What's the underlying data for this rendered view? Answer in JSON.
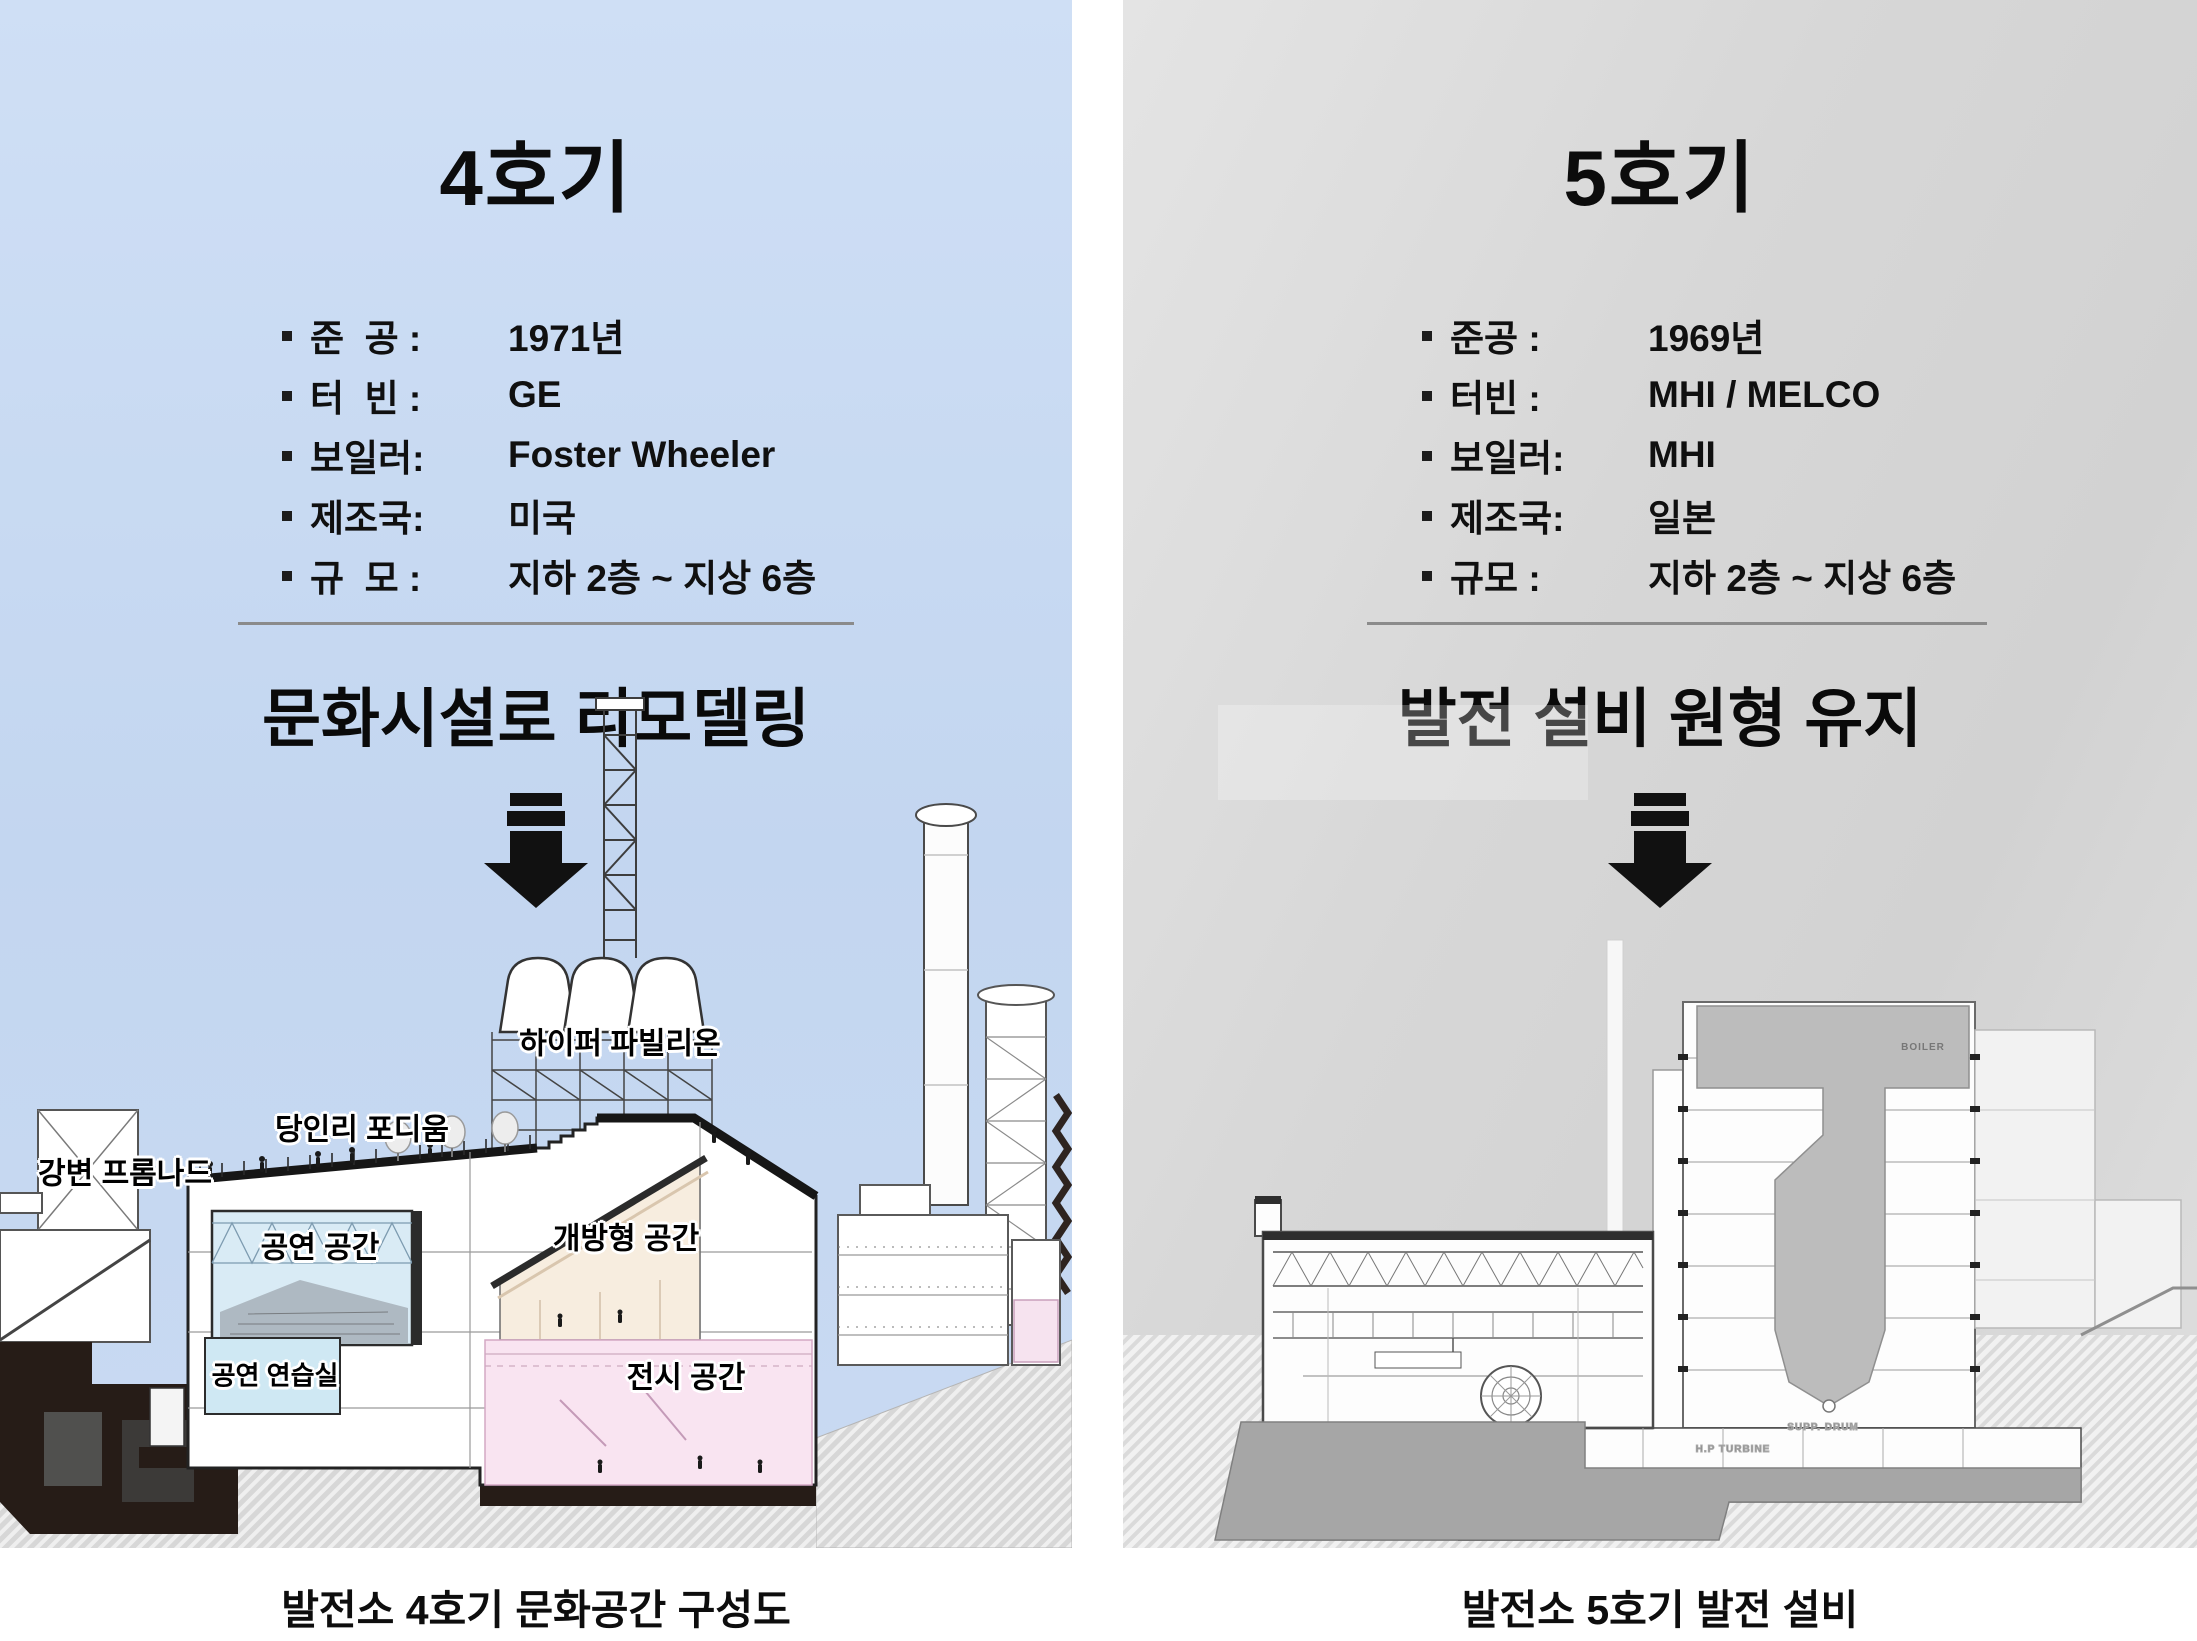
{
  "left": {
    "title": "4호기",
    "specs": [
      {
        "label": "준  공 :",
        "value": "1971년"
      },
      {
        "label": "터  빈 :",
        "value": "GE"
      },
      {
        "label": "보일러:",
        "value": "Foster Wheeler"
      },
      {
        "label": "제조국:",
        "value": "미국"
      },
      {
        "label": "규  모 :",
        "value": "지하 2층 ~ 지상 6층"
      }
    ],
    "headline": "문화시설로 리모델링",
    "labels": {
      "hyper_pavilion": "하이퍼 파빌리온",
      "podium": "당인리 포디움",
      "promenade": "강변 프롬나드",
      "performance": "공연 공간",
      "open_space": "개방형 공간",
      "practice": "공연 연습실",
      "exhibition": "전시 공간"
    },
    "caption": "발전소 4호기 문화공간 구성도",
    "bg_color": "#c6d8f1"
  },
  "right": {
    "title": "5호기",
    "specs": [
      {
        "label": "준공 :",
        "value": "1969년"
      },
      {
        "label": "터빈 :",
        "value": "MHI / MELCO"
      },
      {
        "label": "보일러:",
        "value": "MHI"
      },
      {
        "label": "제조국:",
        "value": "일본"
      },
      {
        "label": "규모 :",
        "value": "지하 2층 ~ 지상 6층"
      }
    ],
    "headline": "발전 설비 원형 유지",
    "tech": {
      "boiler": "BOILER",
      "condenser": "CONDENSER",
      "turbine": "H.P TURBINE",
      "drum": "SUPP. DRUM"
    },
    "caption": "발전소 5호기 발전 설비",
    "bg_color": "#d8d8d8"
  }
}
